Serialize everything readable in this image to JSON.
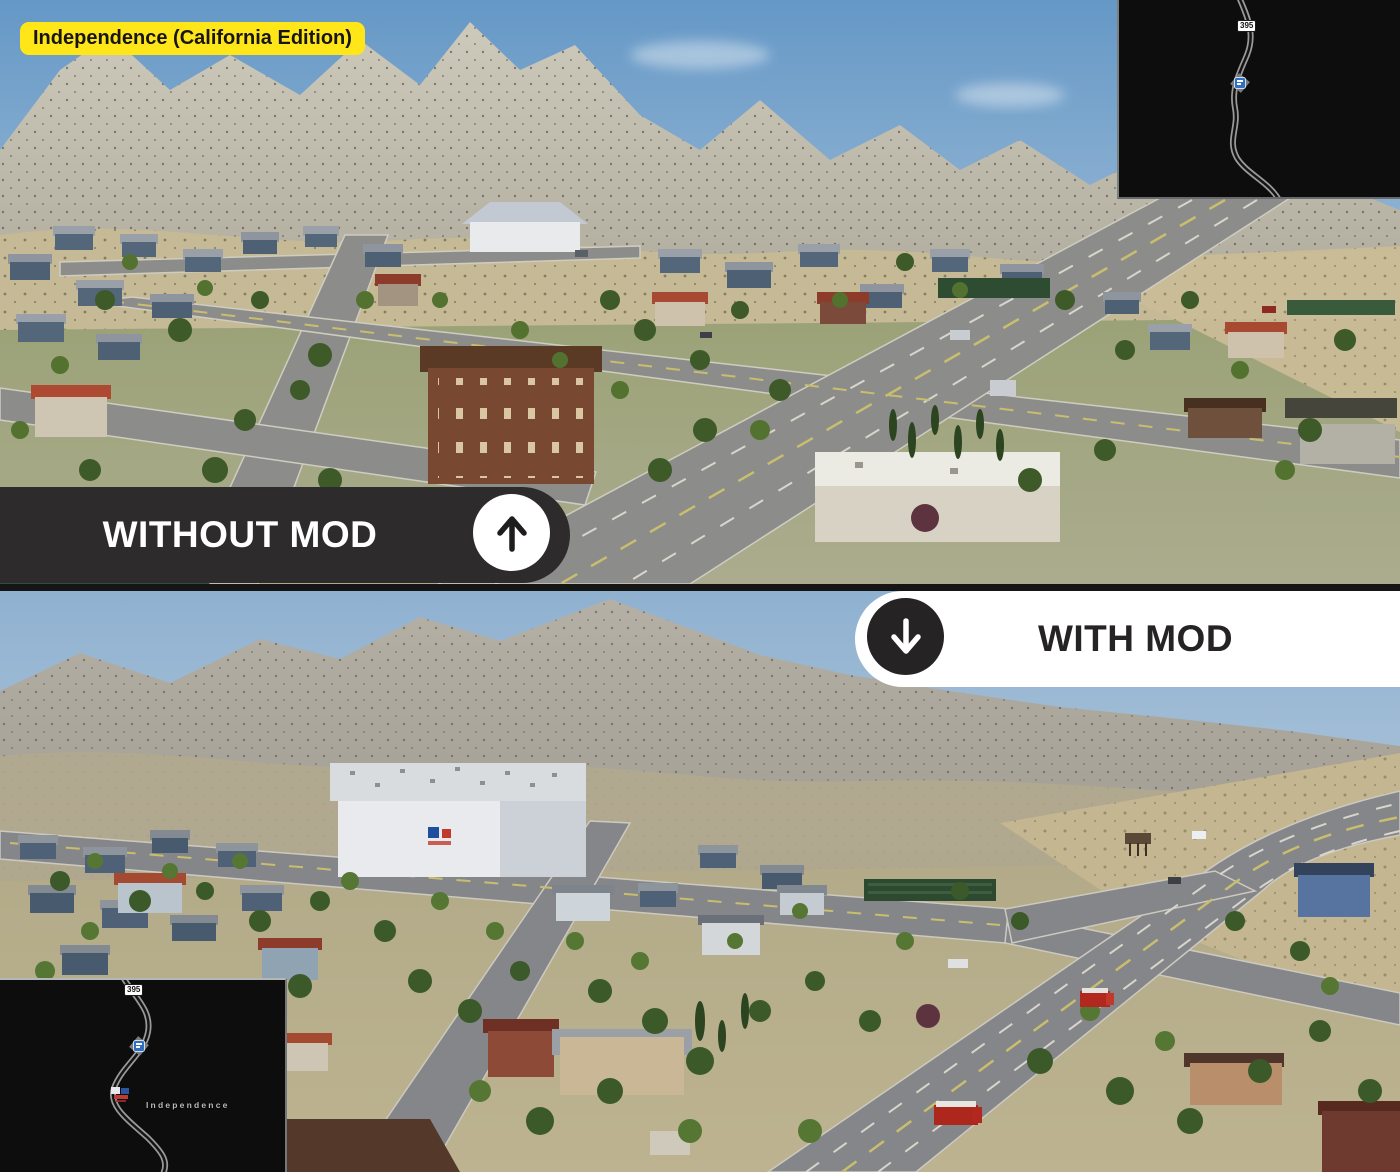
{
  "badge": {
    "label": "Independence (California Edition)"
  },
  "banners": {
    "without": {
      "label": "WITHOUT MOD",
      "icon": "up-arrow-icon"
    },
    "with": {
      "label": "WITH MOD",
      "icon": "down-arrow-icon"
    }
  },
  "minimaps": {
    "top_right": {
      "route_shield": "395",
      "marker_icon": "rest-stop-marker-icon"
    },
    "bottom_left": {
      "route_shield": "395",
      "marker_icon": "rest-stop-marker-icon",
      "company_icon": "company-marker-icon",
      "town_label": "Independence"
    }
  },
  "colors": {
    "badge_bg": "#ffe619",
    "badge_text": "#171513",
    "banner_dark_bg": "#2d2b2c",
    "banner_dark_text": "#ffffff",
    "banner_light_bg": "#ffffff",
    "banner_light_text": "#262324",
    "minimap_bg": "#0d0d0e",
    "minimap_road": "#9a9a98",
    "shield_bg": "#ffffff",
    "shield_text": "#111111",
    "marker_blue": "#2f6fc4",
    "town_label_text": "#b9b9b7"
  }
}
